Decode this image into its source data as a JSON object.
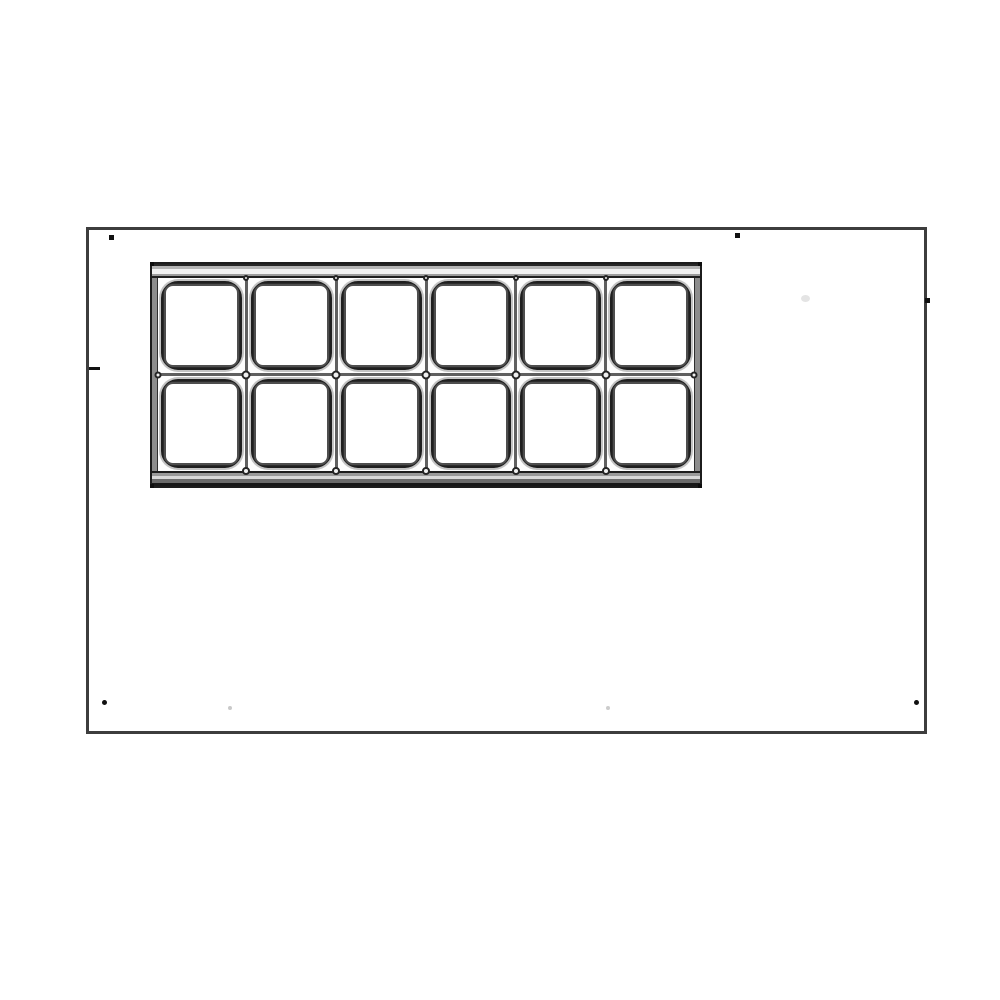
{
  "diagram": {
    "title": "countertop-top-view-with-12-pan-rail",
    "colors": {
      "background": "#ffffff",
      "surface_border": "#3d3d3d",
      "unit_border": "#1c1c1c",
      "pan_line_dark": "#1f1f1f",
      "pan_line_mid": "#2c2c2c",
      "pan_line_light": "#4e4e4e",
      "divider_gray": "#5f5f5f",
      "halo_gray": "#c3c3c3"
    },
    "surface": {
      "x": 86,
      "y": 227,
      "width": 841,
      "height": 507,
      "border_px": 3
    },
    "pan_unit": {
      "x": 150,
      "y": 262,
      "width": 552,
      "height": 226,
      "columns": 6,
      "rows": 2,
      "pan_count": 12,
      "gap_px": 3
    },
    "markers": [
      {
        "name": "screw-dot-top-left",
        "x": 20,
        "y": 5,
        "w": 5,
        "h": 5,
        "color": "#111111",
        "shape": "square"
      },
      {
        "name": "screw-dot-top-center",
        "x": 646,
        "y": 3,
        "w": 5,
        "h": 5,
        "color": "#111111",
        "shape": "square"
      },
      {
        "name": "screw-dot-right-edge",
        "x": 836,
        "y": 68,
        "w": 5,
        "h": 5,
        "color": "#111111",
        "shape": "square"
      },
      {
        "name": "tick-left-edge",
        "x": 0,
        "y": 137,
        "w": 11,
        "h": 3,
        "color": "#111111",
        "shape": "square"
      },
      {
        "name": "screw-dot-bottom-left",
        "x": 13,
        "y": 470,
        "w": 5,
        "h": 5,
        "color": "#111111",
        "shape": "round"
      },
      {
        "name": "screw-dot-bottom-right",
        "x": 825,
        "y": 470,
        "w": 5,
        "h": 5,
        "color": "#111111",
        "shape": "round"
      },
      {
        "name": "faint-dot-bottom-left",
        "x": 139,
        "y": 476,
        "w": 4,
        "h": 4,
        "color": "#c9c9c9",
        "shape": "round"
      },
      {
        "name": "faint-dot-bottom-center",
        "x": 517,
        "y": 476,
        "w": 4,
        "h": 4,
        "color": "#cccccc",
        "shape": "round"
      },
      {
        "name": "faint-smudge-right",
        "x": 712,
        "y": 65,
        "w": 9,
        "h": 7,
        "color": "#e4e4e4",
        "shape": "round"
      }
    ]
  }
}
